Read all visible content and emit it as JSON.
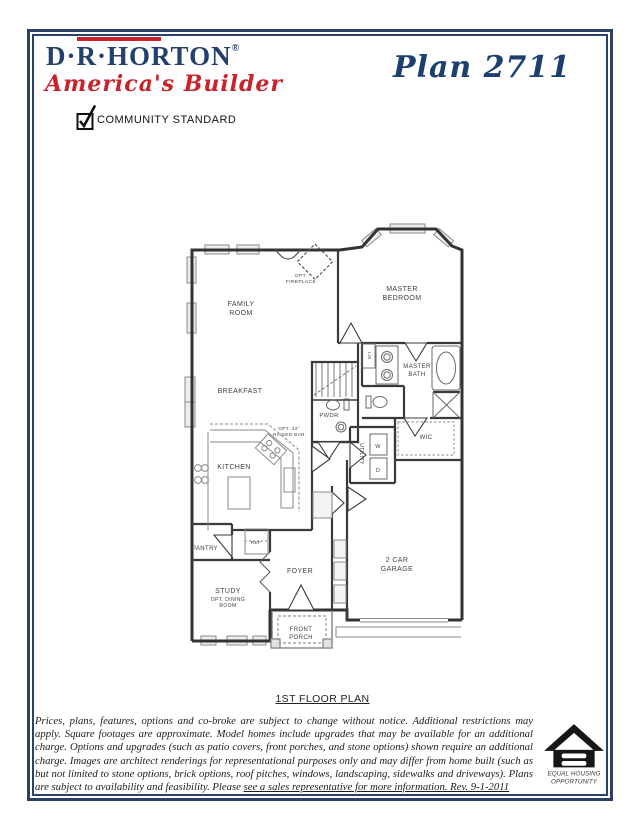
{
  "header": {
    "brand": "D·R·HORTON",
    "registered": "®",
    "tagline": "America's Builder",
    "plan_title": "Plan 2711",
    "standard_label": "COMMUNITY STANDARD"
  },
  "floorplan": {
    "caption": "1ST FLOOR PLAN",
    "rooms": {
      "family_1": "FAMILY",
      "family_2": "ROOM",
      "master_bedroom_1": "MASTER",
      "master_bedroom_2": "BEDROOM",
      "master_bath_1": "MASTER",
      "master_bath_2": "BATH",
      "breakfast": "BREAKFAST",
      "kitchen": "KITCHEN",
      "pwdr": "PWDR",
      "wic": "WIC",
      "utility": "UTILITY",
      "lin": "LIN",
      "pantry": "PANTRY",
      "ref": "REF",
      "foyer": "FOYER",
      "study_1": "STUDY",
      "study_2": "OPT. DINING",
      "study_3": "ROOM",
      "porch_1": "FRONT",
      "porch_2": "PORCH",
      "garage_1": "2 CAR",
      "garage_2": "GARAGE",
      "washer": "W",
      "dryer": "D"
    },
    "annotations": {
      "fireplace_1": "OPT.",
      "fireplace_2": "FIREPLACE",
      "bar_1": "OPT. 42\"",
      "bar_2": "RAISED BAR"
    }
  },
  "footer": {
    "disclaimer": "Prices, plans, features, options and co-broke are subject to change without notice. Additional restrictions may apply. Square footages are approximate. Model homes include upgrades that may be available for an additional charge. Options and upgrades (such as patio covers, front porches, and stone options) shown require an additional charge. Images are architect renderings for representational purposes only and may differ from home built (such as but not limited to stone options, brick options, roof pitches, windows, landscaping, sidewalks and driveways). Plans are subject to availability and feasibility. Please ",
    "disclaimer_underlined": "see a sales representative for more information. Rev. 9-1-2011",
    "eho_1": "EQUAL HOUSING",
    "eho_2": "OPPORTUNITY"
  },
  "colors": {
    "navy": "#2e4067",
    "red": "#c8232b"
  }
}
